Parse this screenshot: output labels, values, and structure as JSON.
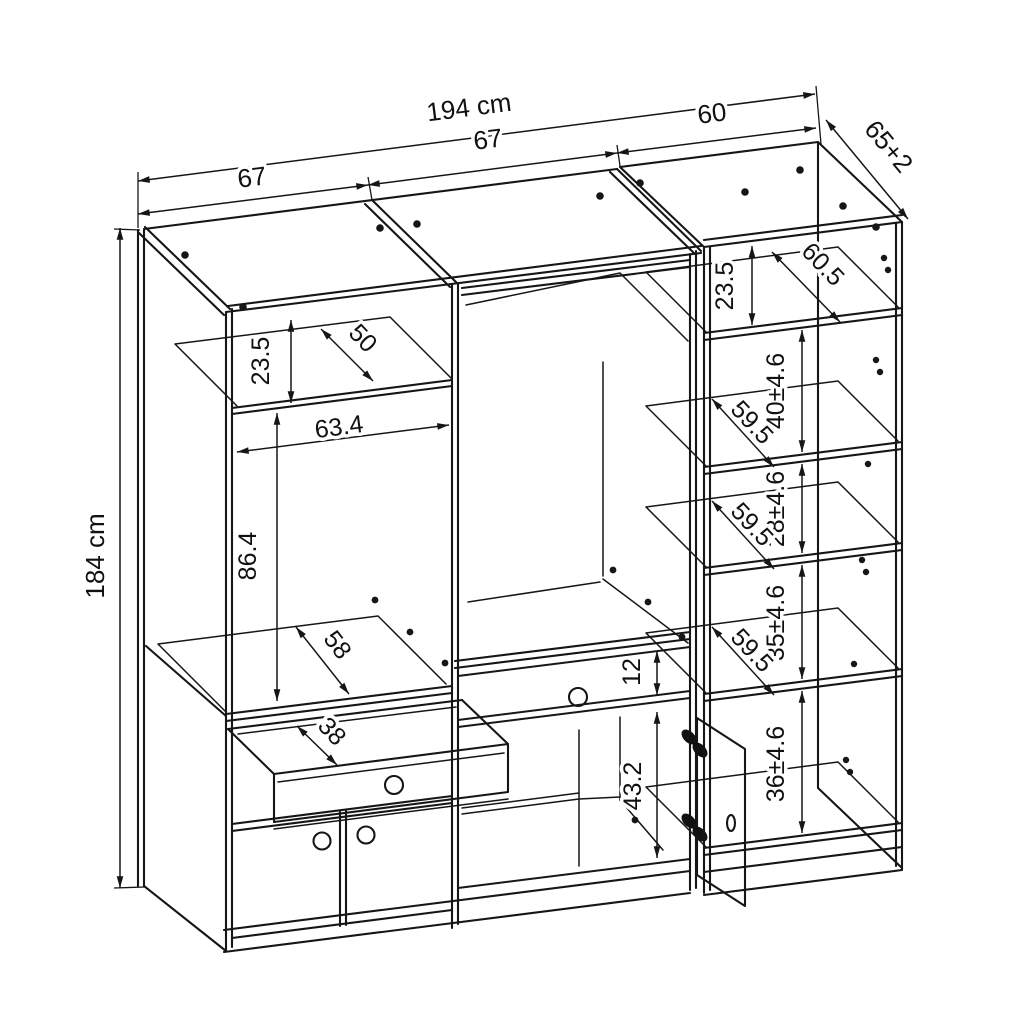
{
  "drawing": {
    "overall": {
      "width": "194 cm",
      "height": "184 cm",
      "depth": "65+2"
    },
    "sections": {
      "left_width": "67",
      "center_width": "67",
      "right_width": "60"
    },
    "left_section": {
      "top_gap": "23.5",
      "top_shelf_depth": "50",
      "interior_width": "63.4",
      "interior_height": "86.4",
      "floor_depth": "58",
      "drawer_depth": "38"
    },
    "center_section": {
      "drawer_front_height": "12",
      "door_height": "43.2"
    },
    "right_section": {
      "top_gap": "23.5",
      "top_shelf_depth": "60.5",
      "shelf_depth": "59.5",
      "gap_1": "40±4.6",
      "gap_2": "28±4.6",
      "gap_3": "35±4.6",
      "gap_4": "36±4.6"
    }
  }
}
